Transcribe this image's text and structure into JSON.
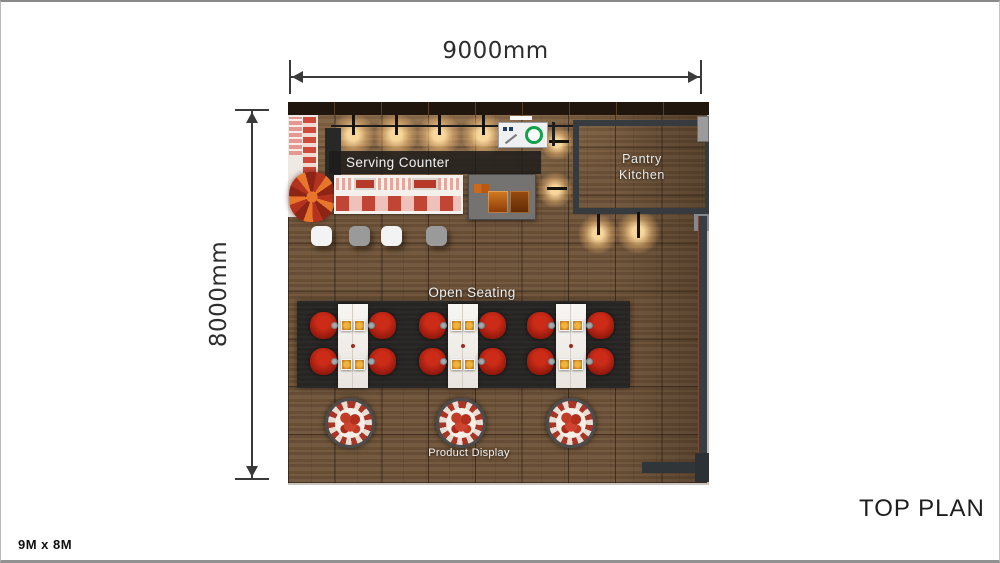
{
  "page": {
    "title": "TOP PLAN",
    "size_note": "9M x 8M",
    "background": "#ffffff"
  },
  "dimensions": {
    "width": "9000mm",
    "height": "8000mm"
  },
  "plan_labels": {
    "serving_counter": "Serving Counter",
    "pantry_line1": "Pantry",
    "pantry_line2": "Kitchen",
    "open_seating": "Open Seating",
    "product_display": "Product Display"
  },
  "furniture": {
    "dining_tables": 3,
    "red_chairs": 12,
    "counter_stools": 4,
    "product_display_tables": 3
  },
  "palette": {
    "floor_wood": "#6d5238",
    "back_wall": "#20160e",
    "label_band": "rgba(30,28,27,0.85)",
    "counter_white": "#f4f0ec",
    "chair_red": "#a31d10",
    "rug_dark": "#272523",
    "pantry_wall": "#363b40",
    "island_gray": "#757371",
    "light_glow": "#ffddA0",
    "dimension_ink": "#3a3a3a"
  }
}
